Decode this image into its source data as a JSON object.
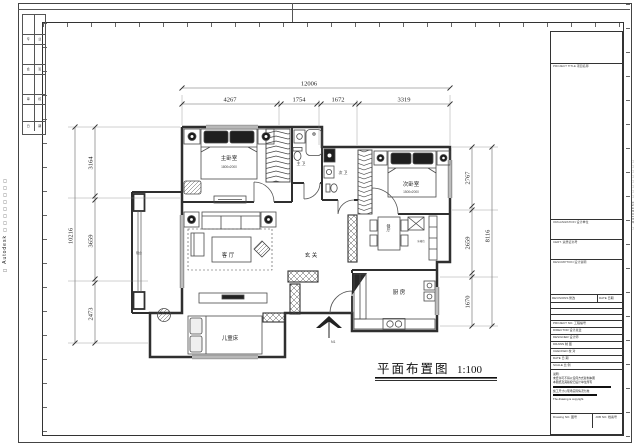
{
  "sheet": {
    "watermark_left": "□ Autodesk □□□□□□□□",
    "watermark_right": "□ Autodesk □□□□□□□□"
  },
  "plan_title": {
    "name": "平面布置图",
    "scale": "1:100"
  },
  "north": {
    "label": "N1"
  },
  "dims": {
    "top_total": "12006",
    "top_segs": [
      "4267",
      "1754",
      "1672",
      "3319"
    ],
    "left_total": "10216",
    "left_segs": [
      "3164",
      "3659",
      "2473"
    ],
    "right_total": "8116",
    "right_segs": [
      "2767",
      "2659",
      "1670"
    ]
  },
  "rooms": {
    "master": "主卧室",
    "master_size": "1800x2000",
    "second": "次卧室",
    "second_size": "1500x2000",
    "living": "客 厅",
    "entry": "玄 关",
    "kitchen": "厨 房",
    "kids": "儿童床",
    "master_bath": "主 卫",
    "second_bath": "次 卫",
    "dining": "餐厅",
    "balcony": "阳台",
    "fridge": "冰箱位"
  },
  "sign_off": [
    [
      "专",
      "业"
    ],
    [
      "会",
      "签"
    ],
    [
      "审",
      "核"
    ],
    [
      "日",
      "期"
    ]
  ],
  "title_block": {
    "project_label": "PROJECT TITLE 项目名称",
    "org_label": "ORGANIZATION 设计单位",
    "cert_label": "CERT. 资质证书号",
    "desc_label": "DESCRIPTION 设计说明",
    "rev_label": "REVISIONS 修改",
    "rev_date_label": "DATE 日期",
    "fields": [
      "PROJECT NO. 工程编号",
      "DIRECTOR 设计总监",
      "DESIGNER 设计师",
      "DRAWN 制 图",
      "CHECKED 校 对",
      "DATE 日 期",
      "SCALE 比 例"
    ],
    "notes": [
      "说明:",
      "未经许可不得以任何方式复制本图",
      "本图纸及其版权归设计单位所有",
      "施工尺寸以现场实际情况为准",
      "The drawing is copyright."
    ],
    "drawing_no_label": "Drawing NO. 图号",
    "job_no_label": "JOB NO. 档案号"
  }
}
